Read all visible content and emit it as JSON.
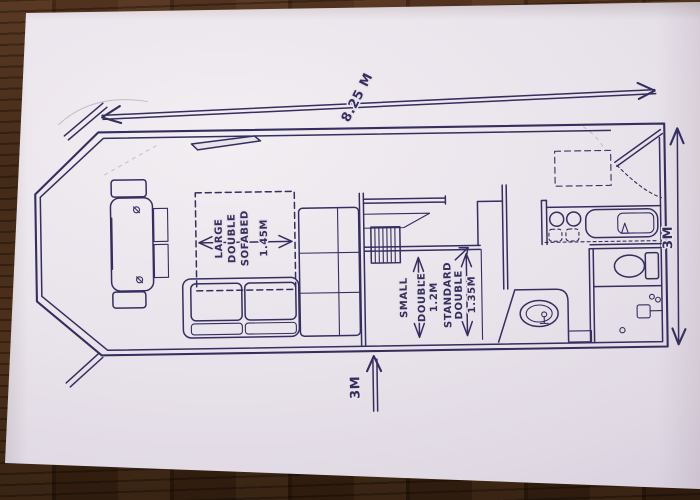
{
  "floorplan": {
    "dimensions": {
      "length_top": "8.25 M",
      "width_right": "3M",
      "width_bottom": "3M"
    },
    "labels": {
      "sofabed": {
        "w1": "LARGE",
        "w2": "DOUBLE",
        "w3": "SOFABED",
        "size": "1.45M"
      },
      "small_double": {
        "w1": "SMALL",
        "w2": "DOUBLE",
        "size": "1.2M"
      },
      "standard_double": {
        "w1": "STANDARD",
        "w2": "DOUBLE",
        "size": "1.35M"
      }
    },
    "colors": {
      "ink": "#352e5e",
      "paper": "#e8e2ea",
      "wood_table": "#3a2315"
    }
  }
}
